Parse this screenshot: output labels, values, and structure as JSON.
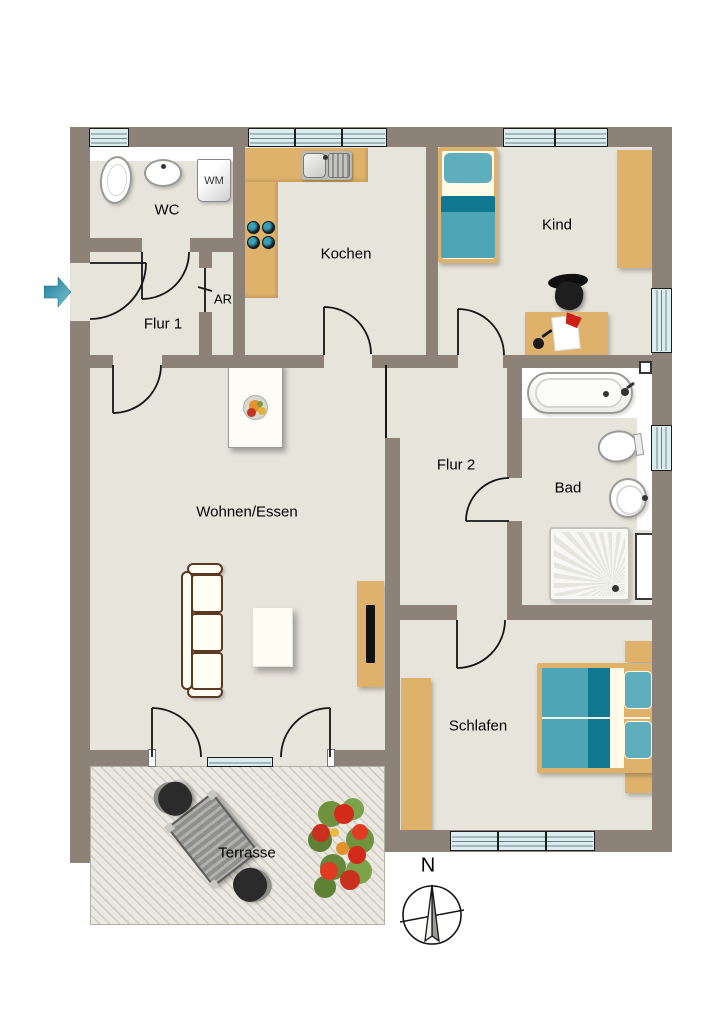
{
  "rooms": {
    "wc": {
      "label": "WC"
    },
    "flur1": {
      "label": "Flur 1"
    },
    "ar": {
      "label": "AR"
    },
    "kochen": {
      "label": "Kochen"
    },
    "kind": {
      "label": "Kind"
    },
    "flur2": {
      "label": "Flur 2"
    },
    "bad": {
      "label": "Bad"
    },
    "wohnen": {
      "label": "Wohnen/Essen"
    },
    "schlafen": {
      "label": "Schlafen"
    },
    "terrasse": {
      "label": "Terrasse"
    }
  },
  "appliances": {
    "washing_machine": {
      "label": "WM"
    }
  },
  "compass": {
    "north": "N"
  },
  "colors": {
    "wall": "#8C8278",
    "floor": "#E7E4DB",
    "wood": "#DFB26C",
    "teal": "#4DA5B6",
    "teal_dark": "#10798F",
    "teal_light": "#5FAEBD",
    "glass": "#DCEDEF",
    "cream": "#FFFBE8",
    "terrace": "#EAE8E1",
    "terrace_stripe": "#CFCCC4",
    "arrow": "#2F8CA6"
  }
}
